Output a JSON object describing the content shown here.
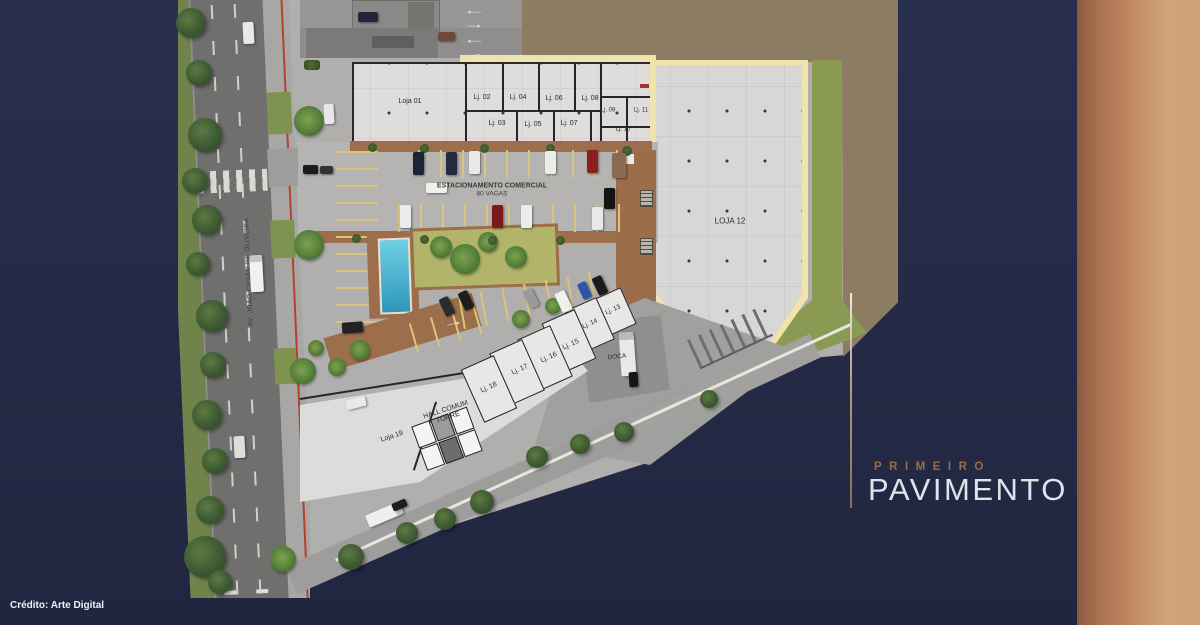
{
  "title": {
    "eyebrow": "PRIMEIRO",
    "main": "PAVIMENTO"
  },
  "credit": "Crédito: Arte Digital",
  "street_name": "AV. JOÃO CESAR DE OLIVEIRA",
  "parking_label": {
    "line1": "ESTACIONAMENTO COMERCIAL",
    "line2": "80 VAGAS"
  },
  "hall_label": {
    "line1": "HALL COMUM",
    "line2": "TORRE"
  },
  "doca_label": "DOCA",
  "shops": [
    {
      "id": "loja-01",
      "label": "Loja 01"
    },
    {
      "id": "lj-02",
      "label": "Lj. 02"
    },
    {
      "id": "lj-03",
      "label": "Lj. 03"
    },
    {
      "id": "lj-04",
      "label": "Lj. 04"
    },
    {
      "id": "lj-05",
      "label": "Lj. 05"
    },
    {
      "id": "lj-06",
      "label": "Lj. 06"
    },
    {
      "id": "lj-07",
      "label": "Lj. 07"
    },
    {
      "id": "lj-08",
      "label": "Lj. 08"
    },
    {
      "id": "lj-09",
      "label": "Lj. 09"
    },
    {
      "id": "lj-10",
      "label": "Lj. 10"
    },
    {
      "id": "lj-11",
      "label": "Lj. 11"
    },
    {
      "id": "loja-12",
      "label": "LOJA 12"
    },
    {
      "id": "lj-13",
      "label": "Lj. 13"
    },
    {
      "id": "lj-14",
      "label": "Lj. 14"
    },
    {
      "id": "lj-15",
      "label": "Lj. 15"
    },
    {
      "id": "lj-16",
      "label": "Lj. 16"
    },
    {
      "id": "lj-17",
      "label": "Lj. 17"
    },
    {
      "id": "lj-18",
      "label": "Lj. 18"
    },
    {
      "id": "loja-19",
      "label": "Loja 19"
    }
  ],
  "colors": {
    "background_navy": "#252b47",
    "accent_copper": "#a5764f",
    "plan_outline_yellow": "#f0e3ac",
    "lawn_green": "#8a9a52",
    "terrain_brown": "#8c7c62"
  }
}
